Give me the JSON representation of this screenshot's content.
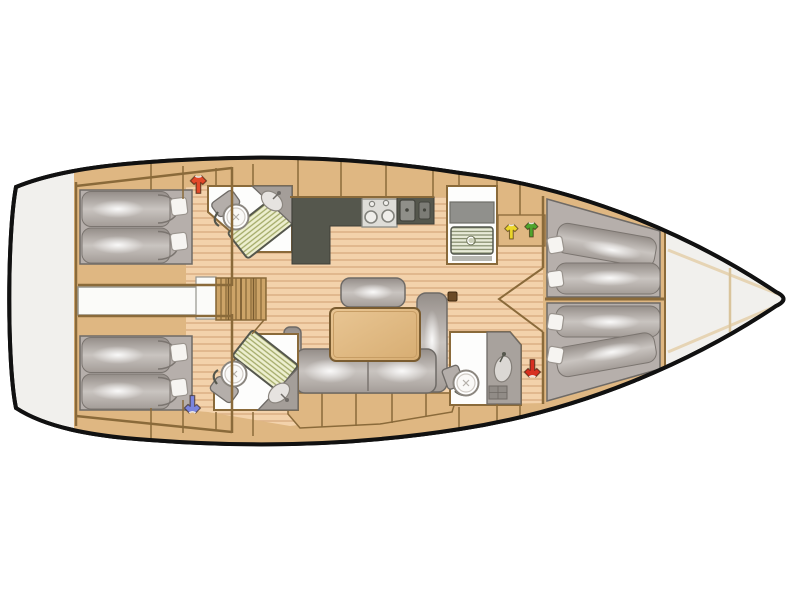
{
  "meta": {
    "title": "Sailing yacht interior layout - top view floor plan",
    "image_type": "boat-floor-plan",
    "background": "#ffffff"
  },
  "colors": {
    "hull_outline": "#111111",
    "hull_fill": "#f1f0ed",
    "wood": "#dfb782",
    "wood_dark": "#8a6a3a",
    "wood_step": "#cda468",
    "floor": "#f3d2ab",
    "floor_line": "#ddb286",
    "gray_base": "#b6afab",
    "gray_dark": "#6e6a66",
    "counter_dark": "#55574d",
    "steel": "#8f8f89",
    "white_room": "#fdfdfc",
    "bench": "#edefcf",
    "bench_line": "#a3aa68",
    "table": "#e2bc87",
    "shirt_red": "#e2492a",
    "shirt_blue": "#7b85dd",
    "shirt_yellow": "#ecd62b",
    "shirt_green": "#4fa42d",
    "shirt_red_fwd": "#d83020"
  },
  "markers": [
    {
      "icon": "tshirt-icon",
      "color_name": "red",
      "area": "aft-cabin-top-locker"
    },
    {
      "icon": "tshirt-icon",
      "color_name": "blue",
      "area": "aft-cabin-bottom-locker"
    },
    {
      "icon": "tshirt-icon",
      "color_name": "yellow",
      "area": "midship-top-shelf"
    },
    {
      "icon": "tshirt-icon",
      "color_name": "green",
      "area": "midship-top-shelf"
    },
    {
      "icon": "tshirt-icon",
      "color_name": "red",
      "area": "forward-bottom-corridor"
    }
  ],
  "features": {
    "aft_cabins": 2,
    "forward_cabins": 2,
    "heads_with_toilet": 3,
    "shower_benches": 2,
    "total_pillows": 8,
    "galley": {
      "stove_burners": 2,
      "sink_basins": 2
    },
    "salon": {
      "sofa": "L-shaped",
      "table": 1,
      "stool_bench": 1
    },
    "companionway_steps": 4
  }
}
